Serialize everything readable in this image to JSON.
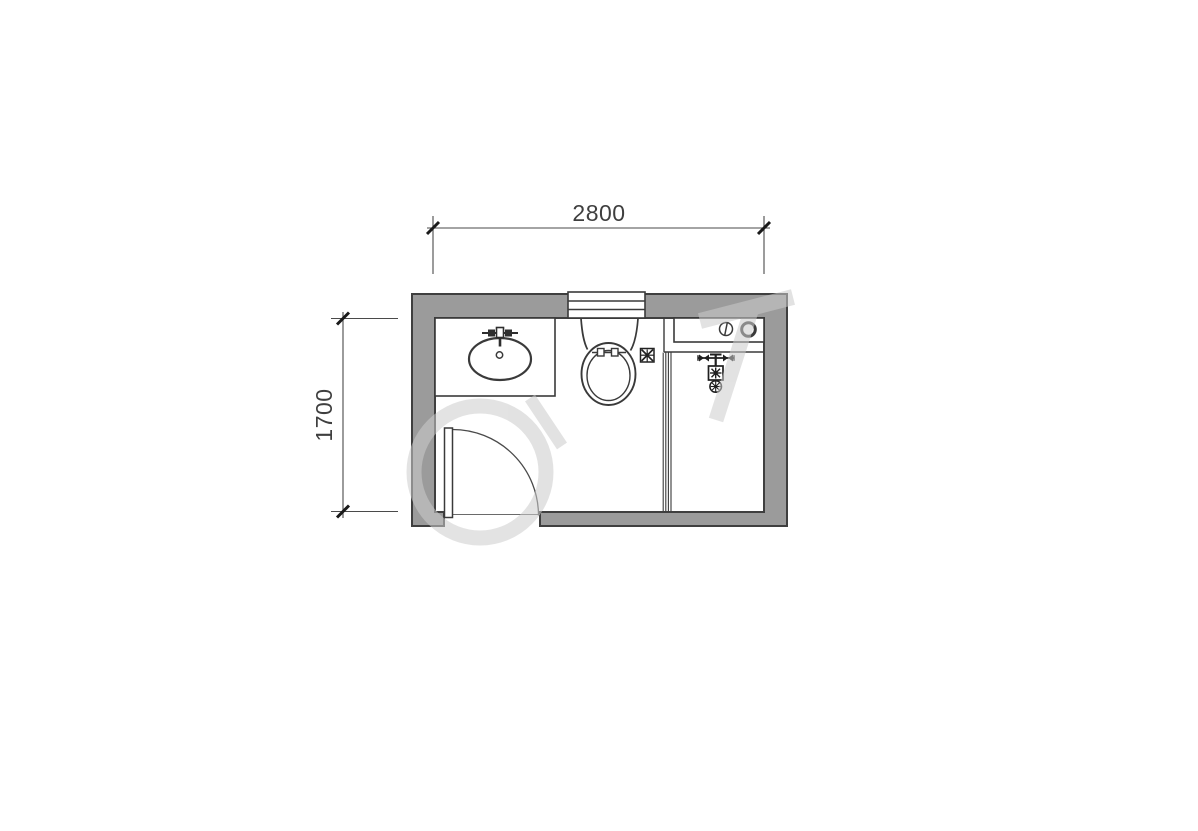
{
  "floor_plan": {
    "room_type": "bathroom",
    "dimensions": {
      "width": {
        "label": "2800"
      },
      "depth": {
        "label": "1700"
      }
    },
    "fixtures": [
      {
        "name": "vanity-sink"
      },
      {
        "name": "faucet"
      },
      {
        "name": "toilet"
      },
      {
        "name": "window"
      },
      {
        "name": "door"
      },
      {
        "name": "floor-drain"
      },
      {
        "name": "washing-machine-counter"
      },
      {
        "name": "shower-mixer"
      },
      {
        "name": "glass-partition"
      }
    ],
    "colors": {
      "wall_fill": "#9b9b9b",
      "wall_outline": "#3f3f3f",
      "line": "#3a3a3a",
      "dimension_text": "#3f3f3f",
      "background": "#ffffff",
      "watermark": "#cccccc"
    }
  }
}
